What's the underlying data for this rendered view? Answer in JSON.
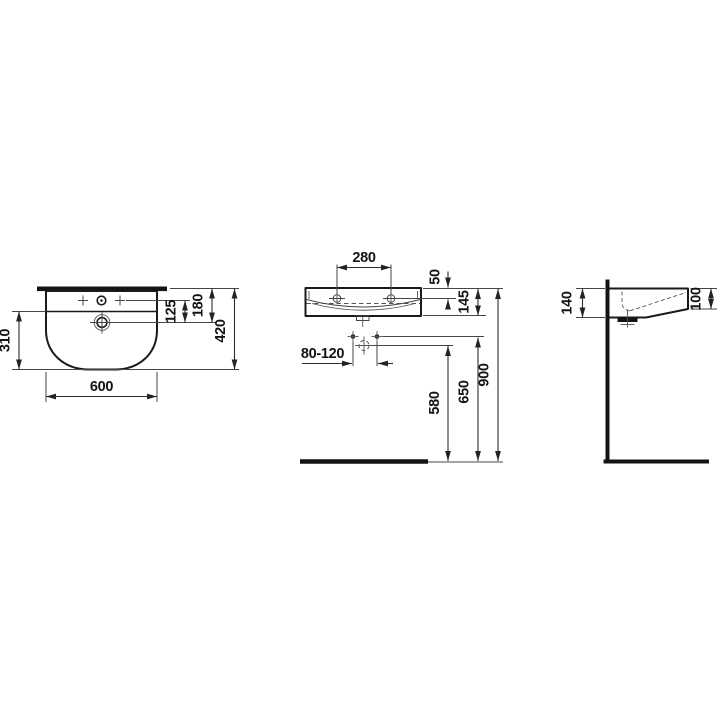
{
  "meta": {
    "type": "technical-dimension-drawing",
    "subject": "wall-hung washbasin, three orthographic views"
  },
  "colors": {
    "background": "#ffffff",
    "line": "#1a1a1a",
    "thin_line": "#454545"
  },
  "views": {
    "top": {
      "label": "top-view",
      "dims": {
        "width": "600",
        "bowl_depth": "310",
        "tap_to_drain": "125",
        "rear_to_drain": "180",
        "overall_depth": "420"
      }
    },
    "front": {
      "label": "front-view",
      "dims": {
        "tap_hole_spacing": "280",
        "rim_to_tap_hole": "50",
        "apron_height": "145",
        "fixing_bolt_spacing": "80-120",
        "trap_height": "580",
        "bolt_height": "650",
        "rim_height": "900"
      }
    },
    "side": {
      "label": "side-view",
      "dims": {
        "depth_at_wall": "140",
        "front_edge_height": "100"
      }
    }
  }
}
